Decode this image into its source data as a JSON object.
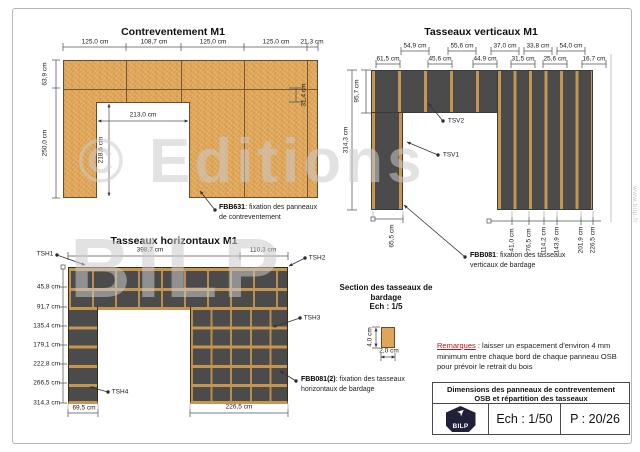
{
  "titles": {
    "contreventement": "Contreventement M1",
    "tasseaux_verticaux": "Tasseaux verticaux M1",
    "tasseaux_horizontaux": "Tasseaux horizontaux M1",
    "section": "Section des tasseaux de\nbardage\nEch : 1/5"
  },
  "dim_labels": [
    {
      "t": "125,0 cm",
      "x": 95,
      "y": 42
    },
    {
      "t": "108,7 cm",
      "x": 154,
      "y": 42
    },
    {
      "t": "125,0 cm",
      "x": 213,
      "y": 42
    },
    {
      "t": "125,0 cm",
      "x": 276,
      "y": 42
    },
    {
      "t": "21,3 cm",
      "x": 312,
      "y": 42
    },
    {
      "t": "63,9 cm",
      "x": 45,
      "y": 74,
      "r": 1
    },
    {
      "t": "250,0 cm",
      "x": 45,
      "y": 143,
      "r": 1
    },
    {
      "t": "31,4 cm",
      "x": 304,
      "y": 95,
      "r": 1
    },
    {
      "t": "213,0 cm",
      "x": 143,
      "y": 115
    },
    {
      "t": "218,6 cm",
      "x": 101,
      "y": 150,
      "r": 1
    },
    {
      "t": "54,9 cm",
      "x": 415,
      "y": 46
    },
    {
      "t": "55,6 cm",
      "x": 462,
      "y": 46
    },
    {
      "t": "37,0 cm",
      "x": 505,
      "y": 46
    },
    {
      "t": "33,8 cm",
      "x": 538,
      "y": 46
    },
    {
      "t": "54,0 cm",
      "x": 571,
      "y": 46
    },
    {
      "t": "61,5 cm",
      "x": 388,
      "y": 59
    },
    {
      "t": "45,6 cm",
      "x": 440,
      "y": 59
    },
    {
      "t": "44,9 cm",
      "x": 485,
      "y": 59
    },
    {
      "t": "31,5 cm",
      "x": 523,
      "y": 59
    },
    {
      "t": "25,6 cm",
      "x": 555,
      "y": 59
    },
    {
      "t": "16,7 cm",
      "x": 594,
      "y": 59
    },
    {
      "t": "95,7 cm",
      "x": 357,
      "y": 91,
      "r": 1
    },
    {
      "t": "314,3 cm",
      "x": 346,
      "y": 140,
      "r": 1
    },
    {
      "t": "65,5 cm",
      "x": 392,
      "y": 236,
      "r": 1
    },
    {
      "t": "41,0 cm",
      "x": 512,
      "y": 240,
      "r": 1
    },
    {
      "t": "76,5 cm",
      "x": 529,
      "y": 240,
      "r": 1
    },
    {
      "t": "114,2 cm",
      "x": 544,
      "y": 240,
      "r": 1
    },
    {
      "t": "143,9 cm",
      "x": 557,
      "y": 240,
      "r": 1
    },
    {
      "t": "201,9 cm",
      "x": 581,
      "y": 240,
      "r": 1
    },
    {
      "t": "226,5 cm",
      "x": 593,
      "y": 240,
      "r": 1
    },
    {
      "t": "TSV2",
      "x": 456,
      "y": 121
    },
    {
      "t": "TSV1",
      "x": 451,
      "y": 155
    },
    {
      "t": "398,7 cm",
      "x": 150,
      "y": 250
    },
    {
      "t": "110,3 cm",
      "x": 263,
      "y": 250
    },
    {
      "t": "TSH1",
      "x": 45,
      "y": 254
    },
    {
      "t": "TSH2",
      "x": 317,
      "y": 258
    },
    {
      "t": "TSH3",
      "x": 312,
      "y": 318
    },
    {
      "t": "TSH4",
      "x": 120,
      "y": 392
    },
    {
      "t": "45,8 cm",
      "x": 60,
      "y": 287,
      "a": 1
    },
    {
      "t": "91,7 cm",
      "x": 60,
      "y": 307,
      "a": 1
    },
    {
      "t": "135,4 cm",
      "x": 60,
      "y": 326,
      "a": 1
    },
    {
      "t": "179,1 cm",
      "x": 60,
      "y": 345,
      "a": 1
    },
    {
      "t": "222,8 cm",
      "x": 60,
      "y": 364,
      "a": 1
    },
    {
      "t": "266,5 cm",
      "x": 60,
      "y": 383,
      "a": 1
    },
    {
      "t": "314,3 cm",
      "x": 60,
      "y": 403,
      "a": 1
    },
    {
      "t": "69,5 cm",
      "x": 84,
      "y": 408
    },
    {
      "t": "226,5 cm",
      "x": 239,
      "y": 407
    },
    {
      "t": "4,0 cm",
      "x": 370,
      "y": 337,
      "r": 1
    },
    {
      "t": "2,0 cm",
      "x": 389,
      "y": 351
    }
  ],
  "callouts": [
    {
      "code": "FBB631",
      "text1": ": fixation des panneaux",
      "text2": "de contreventement",
      "x": 219,
      "y": 203
    },
    {
      "code": "FBB081",
      "text1": ": fixation des tasseaux",
      "text2": "verticaux de bardage",
      "x": 470,
      "y": 251
    },
    {
      "code": "FBB081(2)",
      "text1": ": fixation des tasseaux",
      "text2": "horizontaux de bardage",
      "x": 301,
      "y": 375
    }
  ],
  "remarks": {
    "label": "Remarques",
    "body": " : laisser un espacement d'environ 4 mm minimum entre chaque bord de chaque panneau OSB pour prévoir le retrait du bois"
  },
  "title_block": {
    "line1": "Dimensions des panneaux de contreventement",
    "line2": "OSB et répartition des tasseaux",
    "scale": "Ech : 1/50",
    "page": "P : 20/26",
    "logo_text": "BILP"
  },
  "watermark": {
    "line1": "© Editions",
    "line2": "BILP",
    "side": "www.bilp.fr"
  },
  "colors": {
    "osb_panel": "#e2a95c",
    "wall_dark": "#4b4b4b",
    "batten_tan": "#c6954e",
    "remark_red": "#c11212",
    "logo_navy": "#20203a"
  }
}
